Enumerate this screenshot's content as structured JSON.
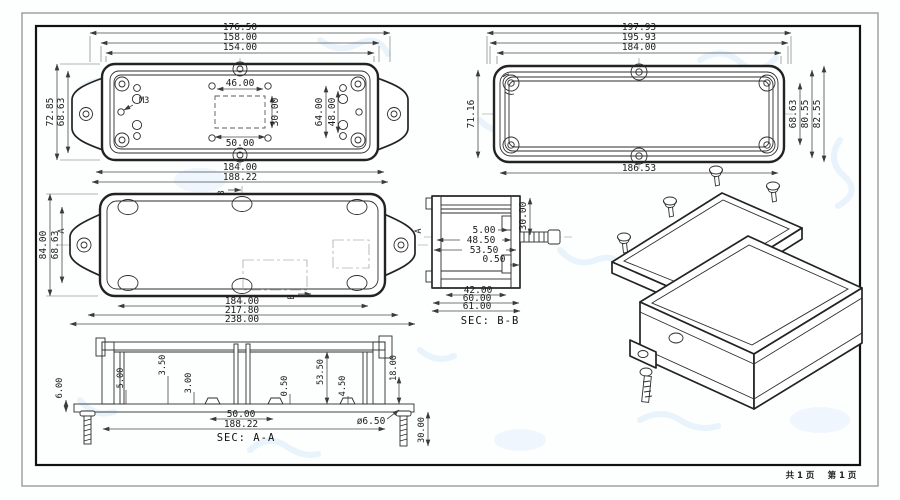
{
  "footer": {
    "total": "共 1 页",
    "page": "第 1 页"
  },
  "base_view": {
    "w1": "176.50",
    "w2": "158.00",
    "w3": "154.00",
    "cutout_w_top": "46.00",
    "cutout_h": "30.00",
    "holes_v1": "64.00",
    "holes_v2": "48.00",
    "cutout_w_bot": "50.00",
    "h1": "72.85",
    "h2": "68.63",
    "thread": "M3",
    "wb1": "184.00",
    "wb2": "188.22"
  },
  "lid_view": {
    "w1": "197.93",
    "w2": "195.93",
    "w3": "184.00",
    "h_left": "71.16",
    "h_r1": "68.63",
    "h_r2": "80.55",
    "h_r3": "82.55",
    "w_bottom": "186.53"
  },
  "bottom_view": {
    "h1": "84.00",
    "h2": "68.63",
    "w1": "184.00",
    "w2": "217.80",
    "w3": "238.00",
    "sec_a": "A",
    "sec_b": "B"
  },
  "sec_bb": {
    "title": "SEC: B-B",
    "d30": "30.00",
    "d5": "5.00",
    "d48_5": "48.50",
    "d53_5": "53.50",
    "d0_5": "0.50",
    "d42": "42.00",
    "d60": "60.00",
    "d61": "61.00"
  },
  "sec_aa": {
    "title": "SEC: A-A",
    "d6": "6.00",
    "d5": "5.00",
    "d3_5": "3.50",
    "d3": "3.00",
    "d0_5": "0.50",
    "d53_5": "53.50",
    "d4_5": "4.50",
    "d18": "18.00",
    "d50": "50.00",
    "d188": "188.22",
    "dia": "ø6.50",
    "d30": "30.00"
  },
  "colors": {
    "line": "#232323",
    "dim": "#4a4a4a",
    "watermark": "#e3eefb",
    "border_outer": "#9a9a9a",
    "border_inner": "#111111"
  }
}
